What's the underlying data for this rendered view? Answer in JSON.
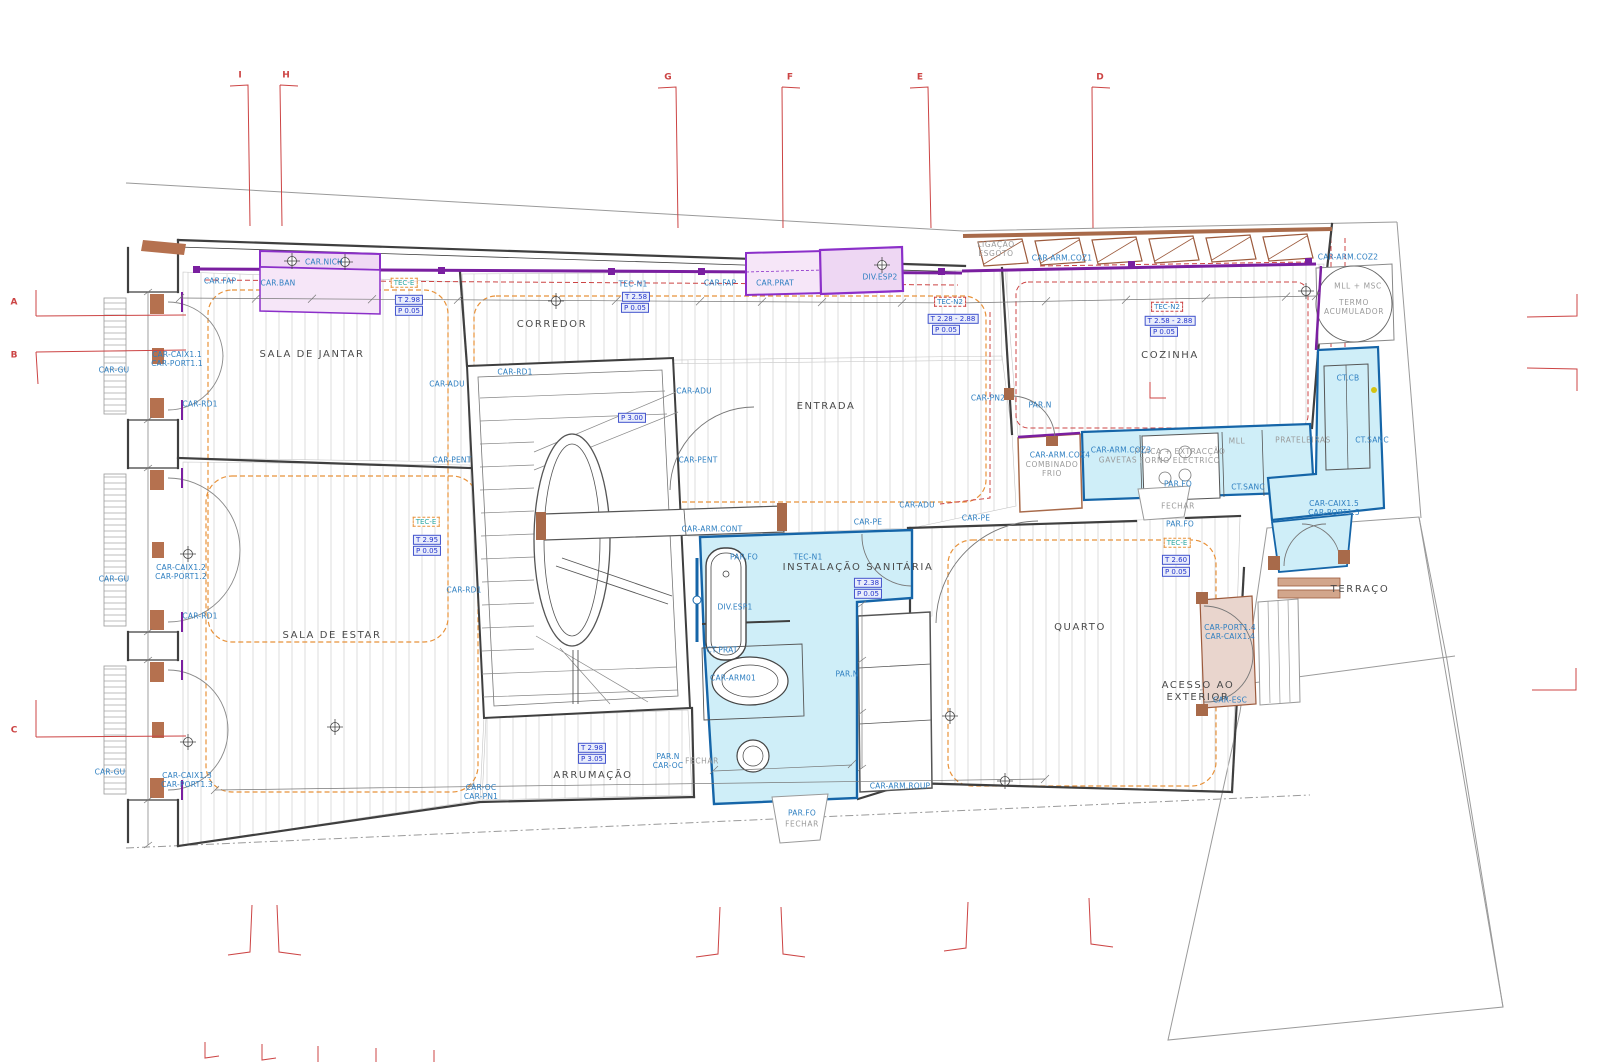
{
  "drawing": {
    "kind": "architectural floor plan",
    "colors": {
      "accent_purple": "#7a1fa0",
      "furniture_pink": "#f6e6f8",
      "sanitary_fill": "#cfeef8",
      "sanitary_border": "#1565a8",
      "wood_brown": "#a86a4a",
      "ceiling_dashed_orange": "#e8923a",
      "axis_red": "#cc4444",
      "code_blue": "#2e7fc1",
      "level_box_blue": "#2233cc",
      "hatch_gray": "#d0d0d0"
    }
  },
  "labels": [
    {
      "kind": "room",
      "text": "SALA DE JANTAR",
      "x": 312,
      "y": 355
    },
    {
      "kind": "room",
      "text": "CORREDOR",
      "x": 552,
      "y": 325
    },
    {
      "kind": "room",
      "text": "ENTRADA",
      "x": 826,
      "y": 407
    },
    {
      "kind": "room",
      "text": "COZINHA",
      "x": 1170,
      "y": 356
    },
    {
      "kind": "room",
      "text": "SALA DE ESTAR",
      "x": 332,
      "y": 636
    },
    {
      "kind": "room",
      "text": "ARRUMAÇÃO",
      "x": 593,
      "y": 776
    },
    {
      "kind": "room",
      "text": "INSTALAÇÃO SANITÁRIA",
      "x": 858,
      "y": 568
    },
    {
      "kind": "room",
      "text": "QUARTO",
      "x": 1080,
      "y": 628
    },
    {
      "kind": "room",
      "text": "TERRAÇO",
      "x": 1360,
      "y": 590
    },
    {
      "kind": "room",
      "text": "ACESSO AO\nEXTERIOR",
      "x": 1198,
      "y": 692
    },
    {
      "kind": "gray",
      "text": "TERMO\nACUMULADOR",
      "x": 1354,
      "y": 307
    },
    {
      "kind": "gray",
      "text": "MLL + MSC",
      "x": 1358,
      "y": 286
    },
    {
      "kind": "gray",
      "text": "LIGAÇÃO\nESGOTO",
      "x": 996,
      "y": 249
    },
    {
      "kind": "gray",
      "text": "FECHAR",
      "x": 1178,
      "y": 506
    },
    {
      "kind": "gray",
      "text": "FECHAR",
      "x": 702,
      "y": 761
    },
    {
      "kind": "gray",
      "text": "FECHAR",
      "x": 802,
      "y": 824
    },
    {
      "kind": "gray",
      "text": "COMBINADO\nFRIO",
      "x": 1052,
      "y": 469
    },
    {
      "kind": "gray",
      "text": "GAVETAS",
      "x": 1118,
      "y": 460
    },
    {
      "kind": "gray",
      "text": "PLACA + EXTRACÇÃO\nFORNO ELÉCTRICO",
      "x": 1180,
      "y": 456
    },
    {
      "kind": "gray",
      "text": "MLL",
      "x": 1237,
      "y": 441
    },
    {
      "kind": "gray",
      "text": "PRATELEIRAS",
      "x": 1303,
      "y": 440
    },
    {
      "kind": "code",
      "text": "CAR.FAP",
      "x": 220,
      "y": 281
    },
    {
      "kind": "code",
      "text": "CAR.BAN",
      "x": 278,
      "y": 283
    },
    {
      "kind": "code",
      "text": "CAR.NICH",
      "x": 324,
      "y": 262
    },
    {
      "kind": "code",
      "text": "TEC-N1",
      "x": 633,
      "y": 284
    },
    {
      "kind": "code",
      "text": "CAR.FAP",
      "x": 720,
      "y": 283
    },
    {
      "kind": "code",
      "text": "CAR.PRAT",
      "x": 775,
      "y": 283
    },
    {
      "kind": "code",
      "text": "DIV.ESP2",
      "x": 880,
      "y": 277
    },
    {
      "kind": "code",
      "text": "CAR-ARM.COZ1",
      "x": 1062,
      "y": 258
    },
    {
      "kind": "code",
      "text": "CAR-ARM.COZ2",
      "x": 1348,
      "y": 257
    },
    {
      "kind": "code",
      "text": "PAR.N",
      "x": 1040,
      "y": 405
    },
    {
      "kind": "code",
      "text": "CAR-PN2",
      "x": 988,
      "y": 398
    },
    {
      "kind": "code",
      "text": "CAR-ADU",
      "x": 447,
      "y": 384
    },
    {
      "kind": "code",
      "text": "CAR-PENT",
      "x": 452,
      "y": 460
    },
    {
      "kind": "code",
      "text": "CAR-ADU",
      "x": 694,
      "y": 391
    },
    {
      "kind": "code",
      "text": "CAR-PENT",
      "x": 698,
      "y": 460
    },
    {
      "kind": "code",
      "text": "CAR-RD1",
      "x": 200,
      "y": 404
    },
    {
      "kind": "code",
      "text": "CAR-RD1",
      "x": 515,
      "y": 372
    },
    {
      "kind": "code",
      "text": "CAR-RD1",
      "x": 200,
      "y": 616
    },
    {
      "kind": "code",
      "text": "CAR-RD1",
      "x": 464,
      "y": 590
    },
    {
      "kind": "code",
      "text": "CAR-GU",
      "x": 114,
      "y": 370
    },
    {
      "kind": "code",
      "text": "CAR-GU",
      "x": 114,
      "y": 579
    },
    {
      "kind": "code",
      "text": "CAR-GU",
      "x": 110,
      "y": 772
    },
    {
      "kind": "code",
      "text": "CAR-CAIX1.1\nCAR-PORT1.1",
      "x": 177,
      "y": 359
    },
    {
      "kind": "code",
      "text": "CAR-CAIX1.2\nCAR-PORT1.2",
      "x": 181,
      "y": 572
    },
    {
      "kind": "code",
      "text": "CAR-CAIX1.3\nCAR-PORT1.3",
      "x": 187,
      "y": 780
    },
    {
      "kind": "code",
      "text": "CAR-OC\nCAR-PN1",
      "x": 481,
      "y": 792
    },
    {
      "kind": "code",
      "text": "CAR-ARM.CONT",
      "x": 712,
      "y": 529
    },
    {
      "kind": "code",
      "text": "PAR.FO",
      "x": 744,
      "y": 557
    },
    {
      "kind": "code",
      "text": "TEC-N1",
      "x": 808,
      "y": 557
    },
    {
      "kind": "code",
      "text": "DIV.ESP1",
      "x": 735,
      "y": 607
    },
    {
      "kind": "code",
      "text": "CT.PRAT",
      "x": 722,
      "y": 650
    },
    {
      "kind": "code",
      "text": "CAR-ARM01",
      "x": 733,
      "y": 678
    },
    {
      "kind": "code",
      "text": "PAR.N",
      "x": 847,
      "y": 674
    },
    {
      "kind": "code",
      "text": "PAR.N\nCAR-OC",
      "x": 668,
      "y": 761
    },
    {
      "kind": "code",
      "text": "CAR-ARM.ROUP",
      "x": 900,
      "y": 786
    },
    {
      "kind": "code",
      "text": "PAR.FO",
      "x": 802,
      "y": 813
    },
    {
      "kind": "code",
      "text": "CAR-ADU",
      "x": 917,
      "y": 505
    },
    {
      "kind": "code",
      "text": "CAR-PE",
      "x": 868,
      "y": 522
    },
    {
      "kind": "code",
      "text": "CAR-PE",
      "x": 976,
      "y": 518
    },
    {
      "kind": "code",
      "text": "CAR-ARM.COZ4",
      "x": 1060,
      "y": 455
    },
    {
      "kind": "code",
      "text": "CAR-ARM.COZ3",
      "x": 1121,
      "y": 450
    },
    {
      "kind": "code",
      "text": "CT.SANC",
      "x": 1248,
      "y": 487
    },
    {
      "kind": "code",
      "text": "CT.SANC",
      "x": 1372,
      "y": 440
    },
    {
      "kind": "code",
      "text": "CT.CB",
      "x": 1348,
      "y": 378
    },
    {
      "kind": "code",
      "text": "PAR.FO",
      "x": 1178,
      "y": 484
    },
    {
      "kind": "code",
      "text": "PAR.FO",
      "x": 1180,
      "y": 524
    },
    {
      "kind": "code",
      "text": "CAR-CAIX1.5\nCAR-PORT1.5",
      "x": 1334,
      "y": 508
    },
    {
      "kind": "code",
      "text": "CAR-PORT1.4\nCAR-CAIX1.4",
      "x": 1230,
      "y": 632
    },
    {
      "kind": "code",
      "text": "CAR-ESC",
      "x": 1230,
      "y": 700
    },
    {
      "kind": "boxb",
      "text": "T 2.98",
      "x": 409,
      "y": 300
    },
    {
      "kind": "boxb",
      "text": "P 0.05",
      "x": 409,
      "y": 311
    },
    {
      "kind": "boxb",
      "text": "T 2.58",
      "x": 636,
      "y": 297
    },
    {
      "kind": "boxb",
      "text": "P 0.05",
      "x": 635,
      "y": 308
    },
    {
      "kind": "boxb",
      "text": "T 2.28 - 2.88",
      "x": 953,
      "y": 319
    },
    {
      "kind": "boxb",
      "text": "P 0.05",
      "x": 946,
      "y": 330
    },
    {
      "kind": "boxb",
      "text": "T 2.58 - 2.88",
      "x": 1170,
      "y": 321
    },
    {
      "kind": "boxb",
      "text": "P 0.05",
      "x": 1164,
      "y": 332
    },
    {
      "kind": "boxb",
      "text": "T 2.95",
      "x": 427,
      "y": 540
    },
    {
      "kind": "boxb",
      "text": "P 0.05",
      "x": 427,
      "y": 551
    },
    {
      "kind": "boxb",
      "text": "T 2.38",
      "x": 868,
      "y": 583
    },
    {
      "kind": "boxb",
      "text": "P 0.05",
      "x": 868,
      "y": 594
    },
    {
      "kind": "boxb",
      "text": "T 2.60",
      "x": 1176,
      "y": 560
    },
    {
      "kind": "boxb",
      "text": "P 0.05",
      "x": 1176,
      "y": 572
    },
    {
      "kind": "boxb",
      "text": "T 2.98",
      "x": 592,
      "y": 748
    },
    {
      "kind": "boxb",
      "text": "P 3.05",
      "x": 592,
      "y": 759
    },
    {
      "kind": "boxb",
      "text": "P 3.00",
      "x": 632,
      "y": 418
    },
    {
      "kind": "boxo",
      "text": "TEC-E",
      "x": 404,
      "y": 283
    },
    {
      "kind": "boxo",
      "text": "TEC-E",
      "x": 426,
      "y": 522
    },
    {
      "kind": "boxo",
      "text": "TEC-E",
      "x": 1177,
      "y": 543
    },
    {
      "kind": "boxr",
      "text": "TEC-N2",
      "x": 950,
      "y": 302
    },
    {
      "kind": "boxr",
      "text": "TEC-N2",
      "x": 1167,
      "y": 307
    },
    {
      "kind": "grid",
      "text": "I",
      "x": 240,
      "y": 76
    },
    {
      "kind": "grid",
      "text": "H",
      "x": 286,
      "y": 76
    },
    {
      "kind": "grid",
      "text": "G",
      "x": 668,
      "y": 78
    },
    {
      "kind": "grid",
      "text": "F",
      "x": 790,
      "y": 78
    },
    {
      "kind": "grid",
      "text": "E",
      "x": 920,
      "y": 78
    },
    {
      "kind": "grid",
      "text": "D",
      "x": 1100,
      "y": 78
    },
    {
      "kind": "grid",
      "text": "A",
      "x": 14,
      "y": 303
    },
    {
      "kind": "grid",
      "text": "B",
      "x": 14,
      "y": 356
    },
    {
      "kind": "grid",
      "text": "C",
      "x": 14,
      "y": 731
    }
  ]
}
